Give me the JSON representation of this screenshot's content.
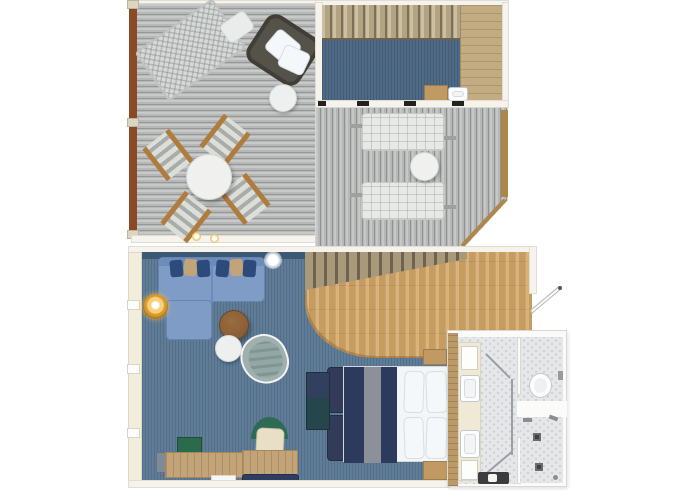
{
  "plan_type": "two-level-suite-floor-plan",
  "colors": {
    "wall": "#f5f3ec",
    "deck_plank": "#b6b8b7",
    "rail_brown": "#8a4a26",
    "rail_tan": "#ad8749",
    "carpet_lower": "#5f7d99",
    "carpet_upper": "#4e6a86",
    "window_glass": "#3d5872",
    "wood_floor": "#c79c61",
    "stair_slat": "#b2a383",
    "landing_wood": "#c3ac82",
    "sofa_blue": "#7e9cc6",
    "pillow_navy": "#2c4a7a",
    "pillow_tan": "#c3a379",
    "lamp_gold": "#d79a28",
    "table_brown": "#8a5e35",
    "egg_chair": "#9fb0ae",
    "bed_blanket": "#2c3a5c",
    "blanket_stripe": "#8c9199",
    "bed_white": "#f3f5f7",
    "bench_navy": "#323c58",
    "nightstand_tan": "#c09a62",
    "bath_tile": "#e6e7e9",
    "vanity_cream": "#efe9d6",
    "wood_wall": "#bb9a6a",
    "chair_green": "#2d6b55",
    "cabinet_green": "#2c6a4d",
    "cabinet_gray": "#7d8a99",
    "desk_wood": "#c3a479"
  },
  "upper_level": {
    "sun_deck_left": [
      "hammock",
      "hammock-pillow",
      "wicker-lounge-chair",
      "chair-pillows",
      "round-side-table",
      "round-dining-table",
      "dining-chair-1",
      "dining-chair-2",
      "dining-chair-3",
      "dining-chair-4",
      "deck-light-1",
      "deck-light-2",
      "wood-railing"
    ],
    "loft_landing": [
      "staircase-upper",
      "carpet",
      "wood-landing",
      "bar-cabinet",
      "bar-sink",
      "window-wall"
    ],
    "sun_deck_right": [
      "sun-lounger-1",
      "sun-lounger-2",
      "round-deck-table",
      "side-railing",
      "corner-wind-screen"
    ]
  },
  "lower_level": {
    "living_area": [
      "sectional-sofa",
      "sofa-pillows",
      "chaise",
      "floor-lamp",
      "ceiling-light",
      "coffee-table",
      "side-table",
      "egg-chair",
      "storage-cabinet",
      "console-cabinet",
      "green-box",
      "gray-box",
      "desk",
      "desk-chair",
      "navy-bench",
      "window-wall-left",
      "glass-strip"
    ],
    "bedroom": [
      "staircase-lower",
      "wood-floor",
      "double-bed",
      "navy-blanket",
      "pillows",
      "foot-bench-1",
      "foot-bench-2",
      "nightstand-1",
      "nightstand-2"
    ],
    "entry": [
      "entrance-door"
    ],
    "bathroom": [
      "wood-partition-wall",
      "double-vanity",
      "sink-1",
      "sink-2",
      "amenity-shelf-top",
      "amenity-shelf-bottom",
      "toilet",
      "toilet-room",
      "shower-room",
      "shower-drain-1",
      "shower-drain-2",
      "shower-head-1",
      "shower-head-2",
      "glass-partition",
      "dark-bench"
    ]
  }
}
